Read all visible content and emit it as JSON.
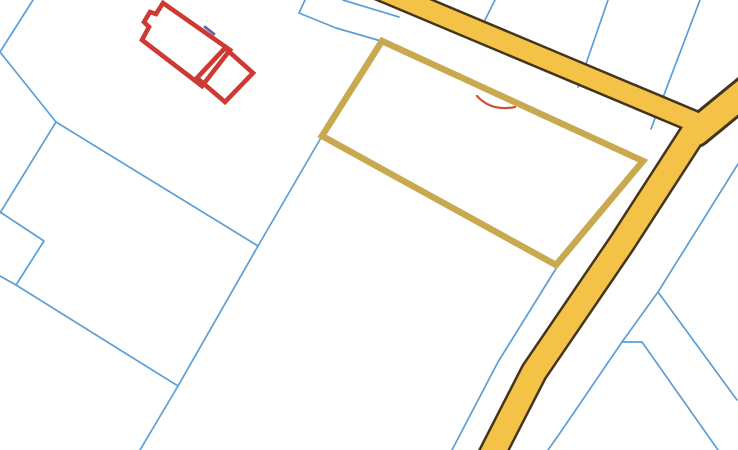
{
  "map": {
    "width": 738,
    "height": 450,
    "background": "#ffffff",
    "colors": {
      "parcel_boundary": "#5b9fd6",
      "selected_parcel": "#c9a94f",
      "building": "#cc3a33",
      "road_core": "#f3c246",
      "road_border": "#43351c",
      "annotation_red": "#d14e38",
      "ink_smudge": "#4c4a8c"
    },
    "stroke_widths": {
      "boundary": 1.7,
      "selected_parcel": 6.5,
      "building": 4.6,
      "annotation": 2.2,
      "smudge": 2.8
    },
    "boundary_lines": [
      {
        "id": "edge-topleft",
        "points": [
          [
            33,
            0
          ],
          [
            0,
            52
          ],
          [
            56,
            122
          ]
        ]
      },
      {
        "id": "j1-to-j2",
        "points": [
          [
            56,
            122
          ],
          [
            258,
            246
          ]
        ]
      },
      {
        "id": "j1-to-leftedge",
        "points": [
          [
            56,
            122
          ],
          [
            0,
            213
          ]
        ]
      },
      {
        "id": "left-step",
        "points": [
          [
            0,
            212
          ],
          [
            44,
            241
          ],
          [
            16,
            285
          ]
        ]
      },
      {
        "id": "left-diagonal",
        "points": [
          [
            0,
            276
          ],
          [
            16,
            285
          ],
          [
            178,
            386
          ]
        ]
      },
      {
        "id": "parcelcorner-to-j2",
        "points": [
          [
            322,
            136
          ],
          [
            258,
            246
          ]
        ]
      },
      {
        "id": "j2-to-bottom",
        "points": [
          [
            258,
            246
          ],
          [
            178,
            386
          ],
          [
            140,
            450
          ]
        ]
      },
      {
        "id": "top-to-parcel",
        "points": [
          [
            305,
            0
          ],
          [
            299,
            13
          ],
          [
            336,
            28
          ],
          [
            381,
            41
          ]
        ]
      },
      {
        "id": "top-under-road",
        "points": [
          [
            343,
            0
          ],
          [
            399,
            17
          ]
        ]
      },
      {
        "id": "road-spur-1",
        "points": [
          [
            495,
            0
          ],
          [
            477,
            36
          ]
        ]
      },
      {
        "id": "road-spur-2",
        "points": [
          [
            608,
            0
          ],
          [
            578,
            87
          ]
        ]
      },
      {
        "id": "road-spur-3",
        "points": [
          [
            700,
            0
          ],
          [
            651,
            129
          ]
        ]
      },
      {
        "id": "right-long",
        "points": [
          [
            738,
            164
          ],
          [
            658,
            292
          ],
          [
            622,
            342
          ],
          [
            560,
            433
          ],
          [
            548,
            450
          ]
        ]
      },
      {
        "id": "right-branch",
        "points": [
          [
            658,
            292
          ],
          [
            737,
            400
          ]
        ]
      },
      {
        "id": "right-jog",
        "points": [
          [
            622,
            342
          ],
          [
            642,
            342
          ],
          [
            718,
            450
          ]
        ]
      },
      {
        "id": "left-of-road",
        "points": [
          [
            557,
            267
          ],
          [
            498,
            362
          ],
          [
            452,
            450
          ]
        ]
      }
    ],
    "roads": [
      {
        "id": "road-main",
        "centerline": [
          [
            350,
            -23
          ],
          [
            700,
            124
          ]
        ],
        "core_width": 19,
        "border_width": 24
      },
      {
        "id": "road-northeast",
        "centerline": [
          [
            762,
            78
          ],
          [
            696,
            132
          ]
        ],
        "core_width": 26,
        "border_width": 32
      },
      {
        "id": "road-south",
        "centerline": [
          [
            697,
            127
          ],
          [
            622,
            243
          ],
          [
            534,
            372
          ],
          [
            494,
            450
          ],
          [
            490,
            458
          ]
        ],
        "core_width": 23.5,
        "border_width": 28.5
      }
    ],
    "selected_parcel": {
      "points": [
        [
          382,
          41
        ],
        [
          643,
          161
        ],
        [
          556,
          265
        ],
        [
          322,
          136
        ]
      ]
    },
    "building": {
      "main_outline": [
        [
          163,
          3
        ],
        [
          230,
          50
        ],
        [
          202,
          86
        ],
        [
          142,
          40
        ],
        [
          149,
          27
        ],
        [
          144,
          22
        ],
        [
          150,
          12
        ],
        [
          156,
          14
        ]
      ],
      "annex_outline": [
        [
          225,
          48
        ],
        [
          253,
          73
        ],
        [
          225,
          102
        ],
        [
          197,
          78
        ]
      ]
    },
    "annotations": {
      "red_mark_path": "M477,96 C487,107 500,110 515,107",
      "smudge_points": [
        [
          205,
          27
        ],
        [
          214,
          34
        ]
      ]
    }
  }
}
